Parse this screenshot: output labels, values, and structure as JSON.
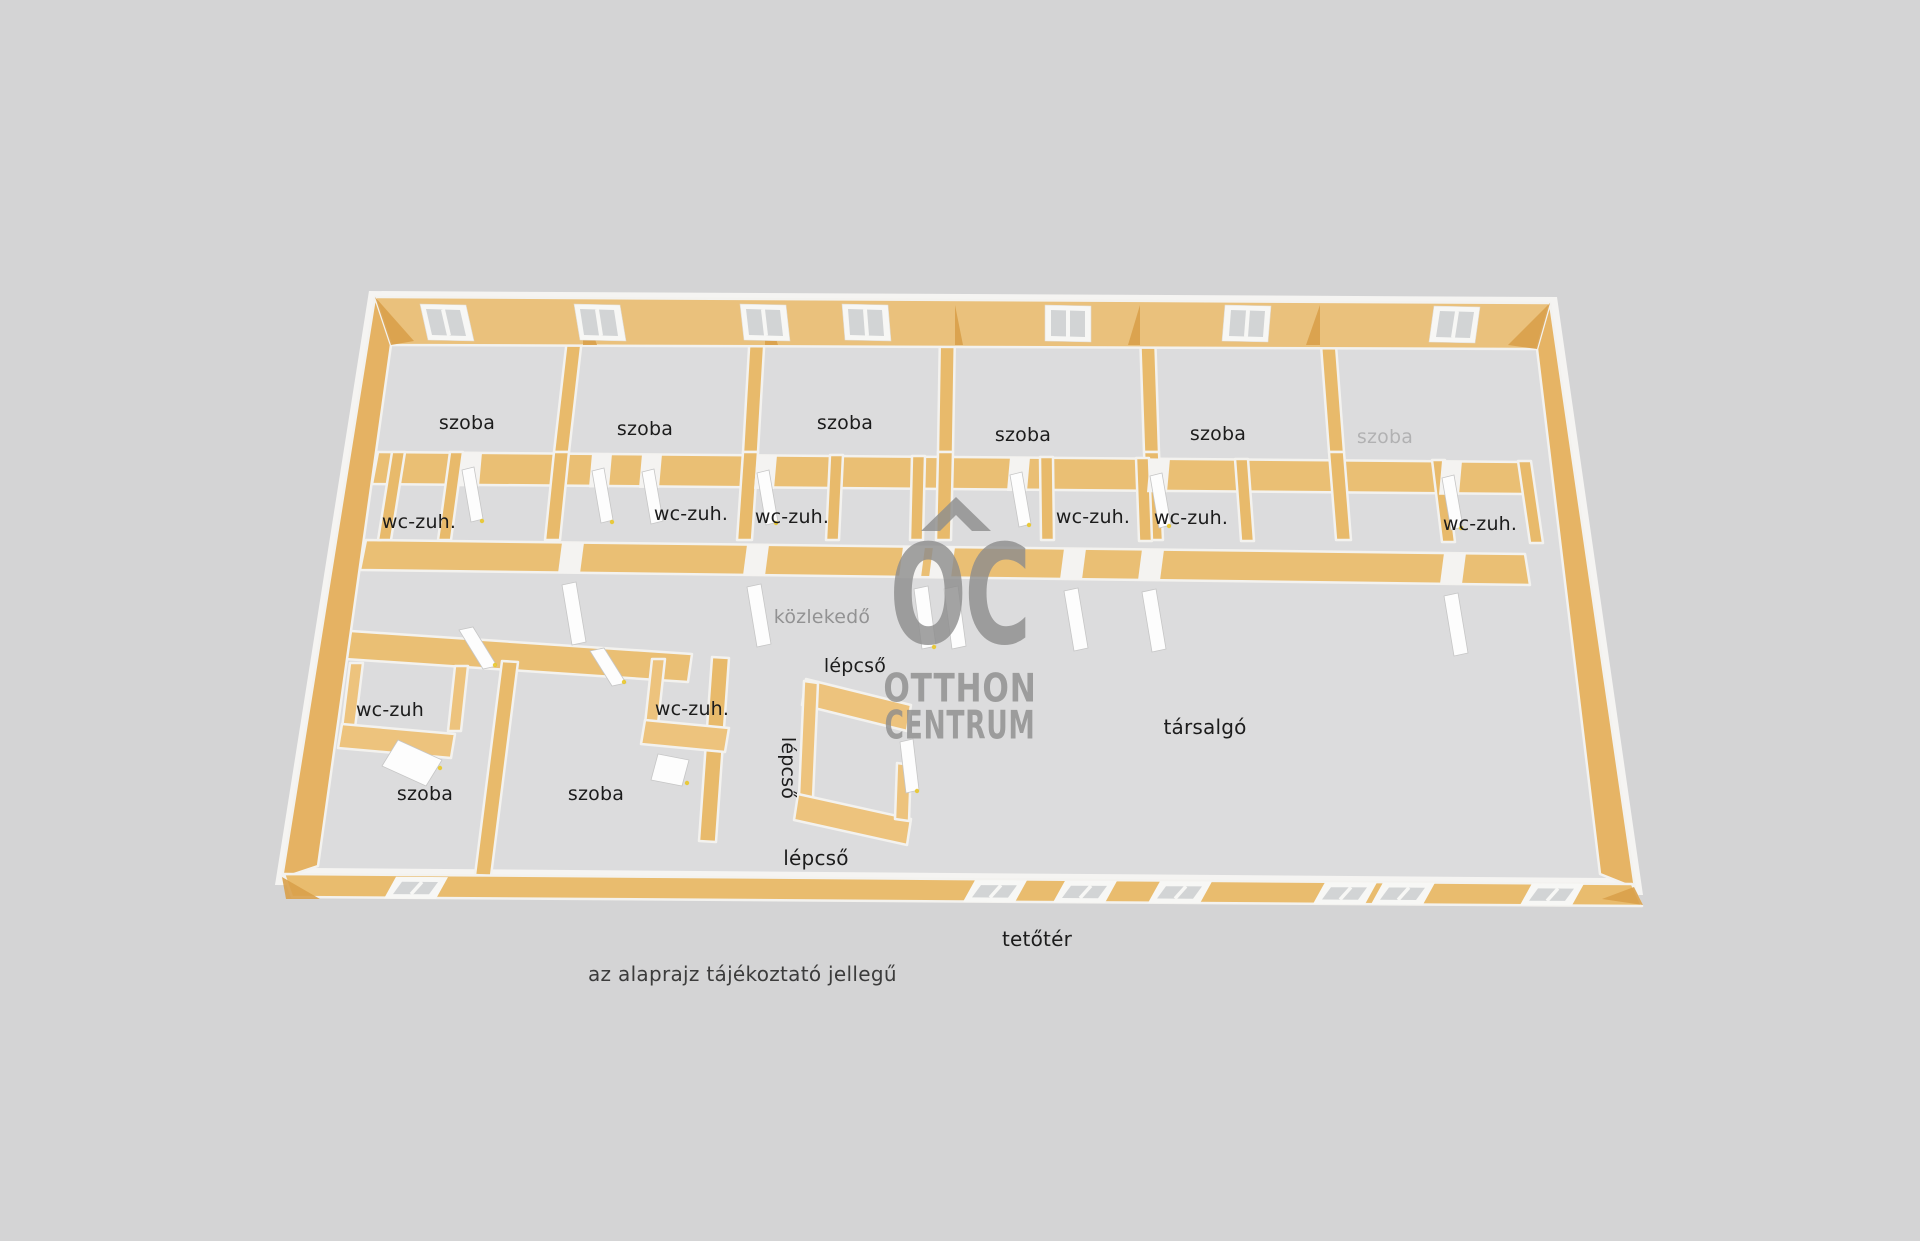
{
  "background_color": "#d4d4d5",
  "rooms": {
    "top": [
      {
        "label": "szoba"
      },
      {
        "label": "szoba"
      },
      {
        "label": "szoba"
      },
      {
        "label": "szoba"
      },
      {
        "label": "szoba"
      },
      {
        "label": "szoba"
      }
    ],
    "top_bath": [
      {
        "label": "wc-zuh."
      },
      {
        "label": "wc-zuh."
      },
      {
        "label": "wc-zuh."
      },
      {
        "label": "wc-zuh."
      },
      {
        "label": "wc-zuh."
      },
      {
        "label": "wc-zuh."
      }
    ],
    "corridor": {
      "label": "közlekedő"
    },
    "stairs": {
      "top": "lépcső",
      "side": "lépcső",
      "bottom": "lépcső"
    },
    "bottom": [
      {
        "label": "szoba"
      },
      {
        "label": "szoba"
      }
    ],
    "bottom_bath": [
      {
        "label": "wc-zuh"
      },
      {
        "label": "wc-zuh."
      }
    ],
    "lounge": {
      "label": "társalgó"
    },
    "attic": {
      "label": "tetőtér"
    }
  },
  "watermark": {
    "monogram": "OC",
    "line1": "OTTHON",
    "line2": "CENTRUM",
    "color": "#8d8d8d",
    "icon": "roof-chevron-icon"
  },
  "disclaimer": {
    "text": "az alaprajz tájékoztató jellegű"
  },
  "colors": {
    "wall": "#eac17c",
    "wall_dark": "#d9a04a",
    "wall_medium": "#e6b465",
    "floor": "#dcdcdd",
    "trim": "#f3f2ef",
    "glass": "#d2d4d5",
    "door": "#fdfdfd",
    "handle_accent": "#e9c62a",
    "label_color": "#1c1c1c"
  }
}
